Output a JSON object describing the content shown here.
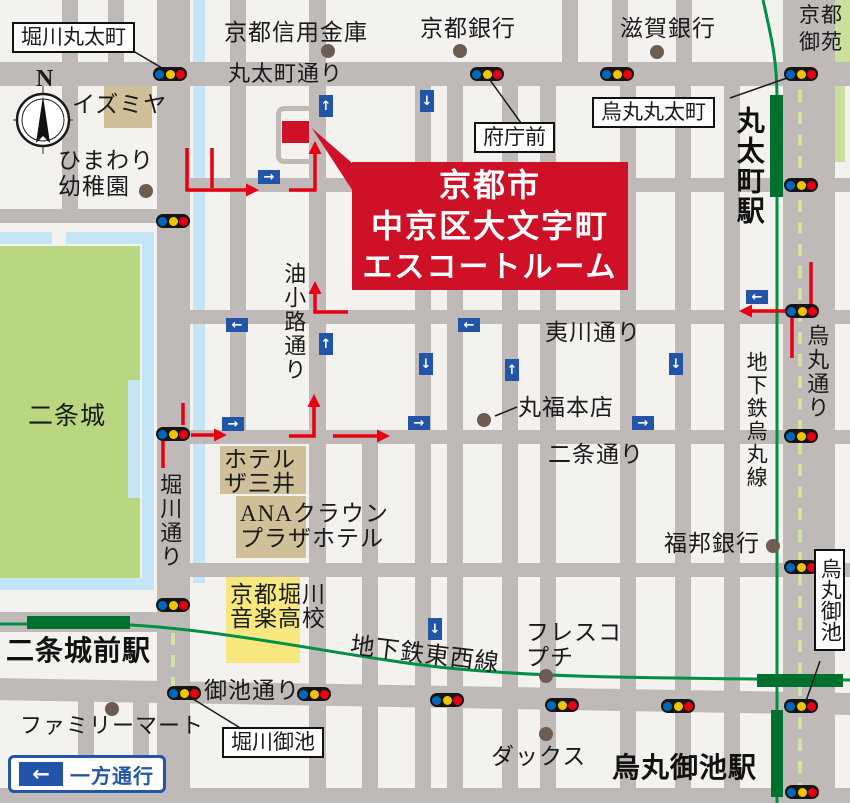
{
  "destination": {
    "line1": "京都市",
    "line2": "中京区大文字町",
    "line3": "エスコートルーム"
  },
  "icons": {
    "left": "←",
    "right": "→",
    "up": "↑",
    "down": "↓"
  },
  "compass": {
    "north": "N"
  },
  "labels": {
    "horikawa_marutamachi": "堀川丸太町",
    "karasuma_marutamachi": "烏丸丸太町",
    "fuchomae": "府庁前",
    "horikawa_oike": "堀川御池",
    "karasuma_oike": "烏丸御池",
    "kyoto_shinkin": "京都信用金庫",
    "kyoto_bank": "京都銀行",
    "shiga_bank": "滋賀銀行",
    "kyoto_gyoen_1": "京都",
    "kyoto_gyoen_2": "御苑",
    "izumiya": "イズミヤ",
    "himawari_1": "ひまわり",
    "himawari_2": "幼稚園",
    "nijo_castle": "二条城",
    "marufuku": "丸福本店",
    "hotel_mitsui_1": "ホテル",
    "hotel_mitsui_2": "ザ三井",
    "ana_1": "ANAクラウン",
    "ana_2": "プラザホテル",
    "fukuho_bank": "福邦銀行",
    "music_school_1": "京都堀川",
    "music_school_2": "音楽高校",
    "fresco_1": "フレスコ",
    "fresco_2": "プチ",
    "dax": "ダックス",
    "familymart": "ファミリーマート",
    "marutamachi_dori": "丸太町通り",
    "aburanokoji_dori": "油小路通り",
    "horikawa_dori": "堀川通り",
    "ebisugawa_dori": "夷川通り",
    "nijo_dori": "二条通り",
    "oike_dori": "御池通り",
    "karasuma_dori": "烏丸通り",
    "tozai_line": "地下鉄東西線",
    "karasuma_line": "地下鉄烏丸線",
    "marutamachi_sta": "丸太町駅",
    "nijojomae_sta": "二条城前駅",
    "karasuma_oike_sta": "烏丸御池駅",
    "one_way": "一方通行"
  },
  "colors": {
    "street": "#bfbab7",
    "block": "#f4f2ef",
    "destination_red": "#ce1126",
    "route_red": "#e60012",
    "subway_green": "#009045",
    "station_green": "#00702e",
    "park_green": "#b9d77e",
    "water_blue": "#c3e5f5",
    "sign_blue": "#2255a8",
    "signal_blue": "#0068b7",
    "signal_yellow": "#f1c400",
    "signal_red": "#e60012",
    "building_tan": "#cfc099",
    "building_yellow": "#f6e87e",
    "poi_dot": "#6e5c50"
  }
}
